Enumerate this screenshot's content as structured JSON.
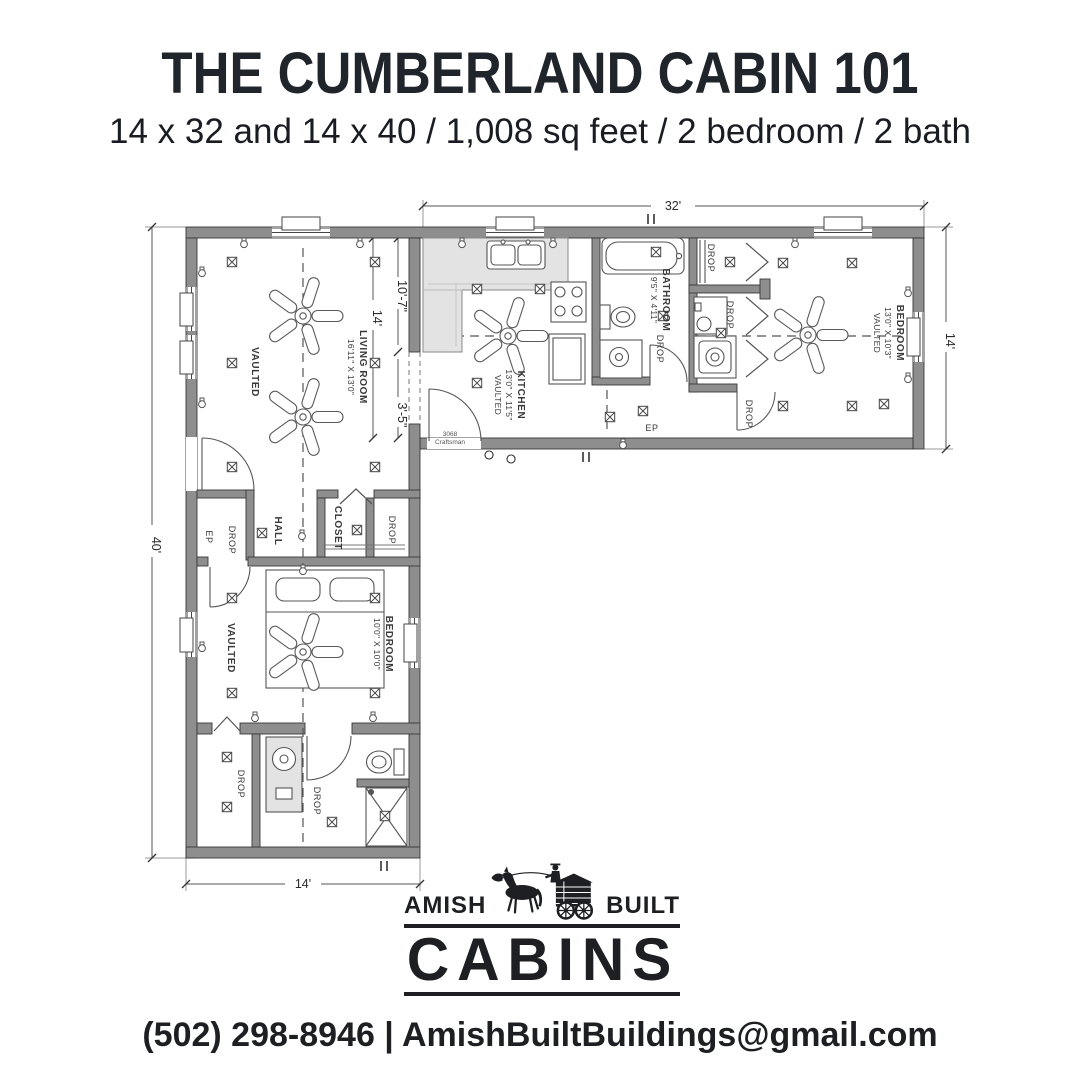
{
  "header": {
    "title": "THE CUMBERLAND CABIN 101",
    "subtitle": "14 x 32 and 14 x 40 / 1,008 sq feet / 2 bedroom / 2 bath"
  },
  "plan": {
    "dims": {
      "wing_top": "32'",
      "wing_right": "14'",
      "left_side": "40'",
      "bottom": "14'",
      "junction_total": "14'",
      "junction_upper": "10'-7\"",
      "junction_lower": "3'-5\""
    },
    "rooms": {
      "living": {
        "name": "LIVING ROOM",
        "size": "16'11\" X 13'0\"",
        "note": "VAULTED"
      },
      "kitchen": {
        "name": "KITCHEN",
        "size": "13'0\" X 11'5\"",
        "note": "VAULTED"
      },
      "bath_main": {
        "name": "BATHROOM",
        "size": "9'5\" X 4'11\""
      },
      "bedroom_main": {
        "name": "BEDROOM",
        "size": "13'0\" X 10'3\"",
        "note": "VAULTED"
      },
      "bedroom_second": {
        "name": "BEDROOM",
        "size": "10'0\" X 10'0\"",
        "note": "VAULTED"
      },
      "hall": {
        "name": "HALL"
      },
      "closet": {
        "name": "CLOSET"
      }
    },
    "labels": {
      "drop": "DROP",
      "ep": "EP",
      "door_tag_size": "3068",
      "door_tag_type": "Craftsman"
    }
  },
  "logo": {
    "word_left": "AMISH",
    "word_right": "BUILT",
    "word_main": "CABINS"
  },
  "footer": {
    "contact": "(502) 298-8946 | AmishBuiltBuildings@gmail.com"
  },
  "colors": {
    "ink": "#20242b",
    "wall": "#8e8e8e",
    "line": "#3a3a3a"
  }
}
